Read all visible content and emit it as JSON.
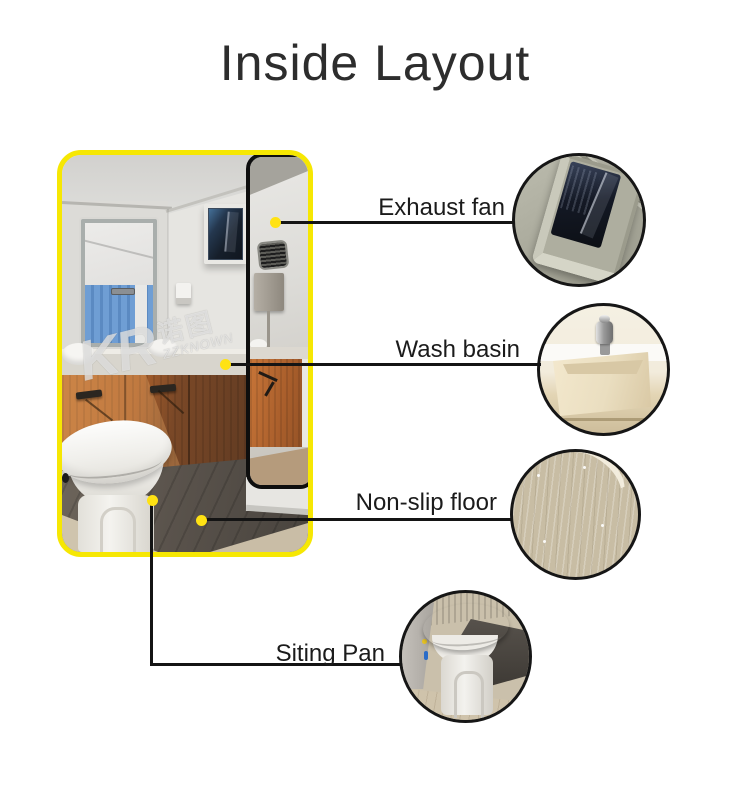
{
  "title": "Inside Layout",
  "watermark": {
    "brand": "KR",
    "cn": "诺图",
    "sub": "ZZKNOWN"
  },
  "callouts": [
    {
      "id": "exhaust-fan",
      "label": "Exhaust fan"
    },
    {
      "id": "wash-basin",
      "label": "Wash basin"
    },
    {
      "id": "non-slip-floor",
      "label": "Non-slip floor"
    },
    {
      "id": "siting-pan",
      "label": "Siting Pan"
    }
  ],
  "colors": {
    "photo_border_yellow": "#f6e703",
    "callout_dot_yellow": "#ffe213",
    "connector_line": "#141414",
    "circle_border": "#161616",
    "title_text": "#2d2d2d",
    "label_text": "#1b1b1b",
    "background": "#ffffff"
  }
}
